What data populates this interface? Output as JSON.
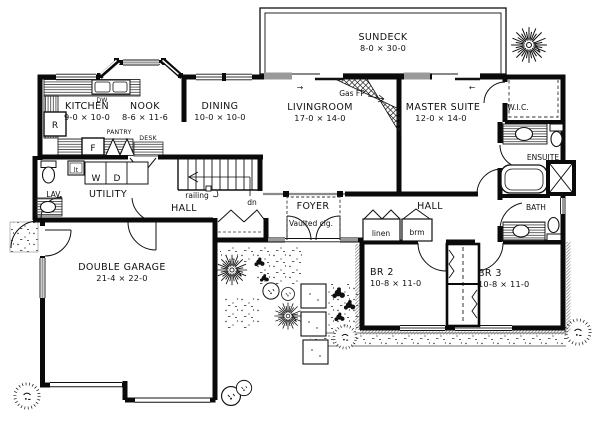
{
  "plan": {
    "rooms": {
      "sundeck": {
        "name": "SUNDECK",
        "dims": "8-0 × 30-0"
      },
      "kitchen": {
        "name": "KITCHEN",
        "dims": "9-0 × 10-0"
      },
      "nook": {
        "name": "NOOK",
        "dims": "8-6 × 11-6"
      },
      "dining": {
        "name": "DINING",
        "dims": "10-0 × 10-0"
      },
      "livingroom": {
        "name": "LIVINGROOM",
        "dims": "17-0 × 14-0"
      },
      "master": {
        "name": "MASTER SUITE",
        "dims": "12-0 × 14-0"
      },
      "wic": {
        "name": "W.I.C."
      },
      "ensuite": {
        "name": "ENSUITE"
      },
      "bath": {
        "name": "BATH"
      },
      "hall_right": {
        "name": "HALL"
      },
      "hall_left": {
        "name": "HALL"
      },
      "foyer": {
        "name": "FOYER",
        "note": "Vaulted clg."
      },
      "utility": {
        "name": "UTILITY"
      },
      "lav": {
        "name": "LAV."
      },
      "garage": {
        "name": "DOUBLE GARAGE",
        "dims": "21-4 × 22-0"
      },
      "br2": {
        "name": "BR 2",
        "dims": "10-8 × 11-0"
      },
      "br3": {
        "name": "BR 3",
        "dims": "10-8 × 11-0"
      }
    },
    "labels": {
      "gas_fp": "Gas FP",
      "railing": "railing",
      "down": "dn",
      "linen": "linen",
      "broom": "brm",
      "pantry": "PANTRY",
      "desk": "DESK",
      "dishwasher": "DW",
      "fridge": "R",
      "freezer": "F",
      "washer": "W",
      "dryer": "D",
      "laundry_tub": "lt",
      "arrow_right": "→",
      "arrow_left": "←"
    },
    "colors": {
      "ink": "#101010",
      "paper": "#ffffff",
      "glass": "#9a9a9a"
    }
  }
}
